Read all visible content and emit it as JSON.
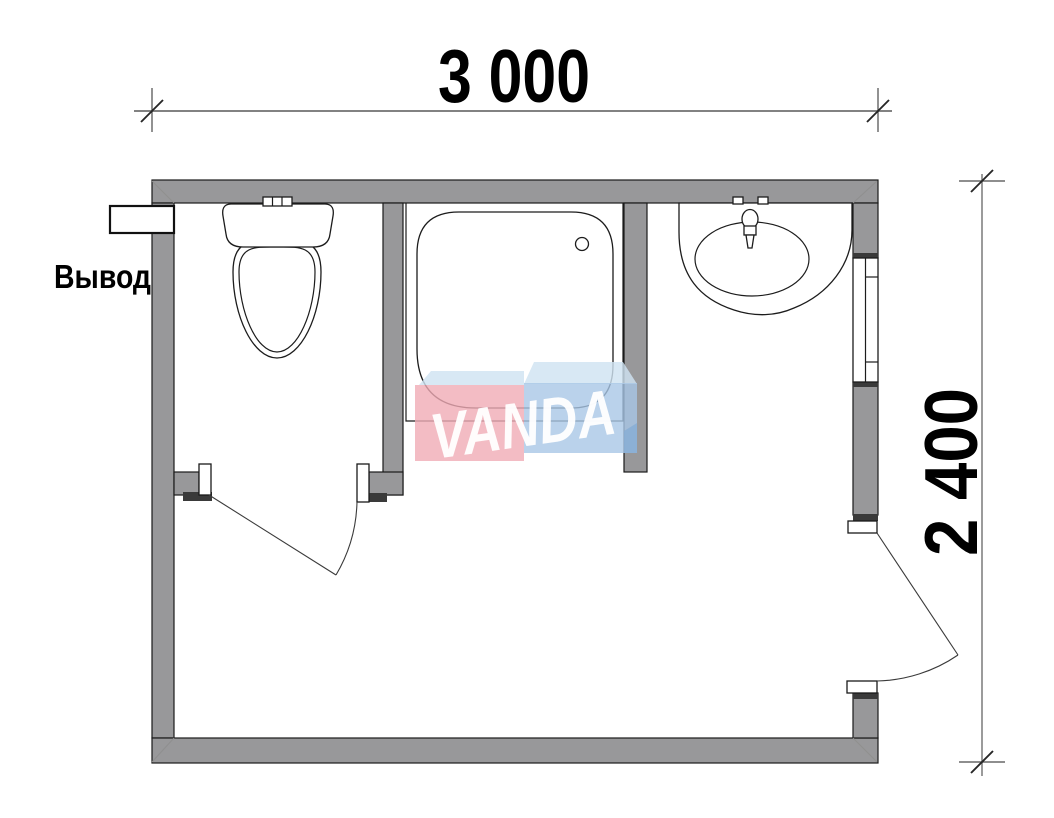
{
  "drawing": {
    "type": "floor-plan",
    "rooms": [
      "wc",
      "shower",
      "washroom"
    ]
  },
  "dimensions": {
    "width_label": "3 000",
    "height_label": "2 400"
  },
  "labels": {
    "outlet_label": "Вывод"
  },
  "watermark": {
    "text": "VANDA"
  },
  "fixtures": {
    "toilet": "toilet",
    "shower": "shower-tray",
    "sink": "washbasin",
    "window": "window",
    "doors": [
      "wc-door",
      "entrance-door"
    ],
    "pipe": "outlet-pipe"
  },
  "colors": {
    "wall": "#98989a",
    "outline": "#1a1a1a",
    "dim_line": "#828282",
    "watermark_red": "#f0abb5",
    "watermark_blue": "#a9c7e6",
    "watermark_light_blue": "#cfe3f2",
    "watermark_fold": "#86add4",
    "watermark_text": "#ffffff"
  }
}
